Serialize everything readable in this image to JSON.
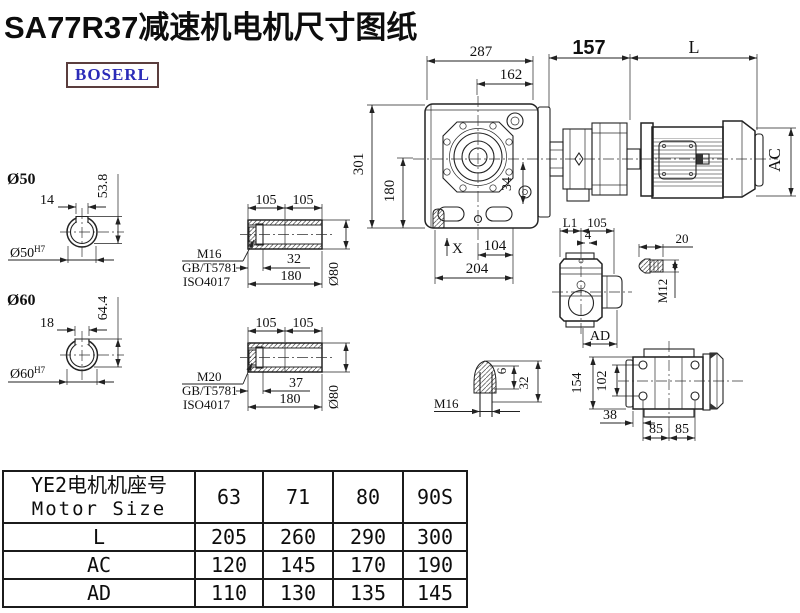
{
  "title": "SA77R37减速机电机尺寸图纸",
  "logo_text": "BOSERL",
  "main_view": {
    "dim_287": "287",
    "dim_162": "162",
    "dim_157": "157",
    "dim_L": "L",
    "dim_AC": "AC",
    "dim_301": "301",
    "dim_180": "180",
    "dim_34": "34",
    "dim_X": "X",
    "dim_104": "104",
    "dim_204": "204"
  },
  "shaft_50": {
    "title": "Ø50",
    "bore_label": "Ø50",
    "bore_tolerance": "H7",
    "key_width": "14",
    "key_depth": "53.8",
    "bolt_callout": {
      "line1": "M16",
      "line2": "GB/T5781",
      "line3": "ISO4017"
    }
  },
  "shaft_60": {
    "title": "Ø60",
    "bore_label": "Ø60",
    "bore_tolerance": "H7",
    "key_width": "18",
    "key_depth": "64.4",
    "bolt_callout": {
      "line1": "M20",
      "line2": "GB/T5781",
      "line3": "ISO4017"
    }
  },
  "hollow_shaft_top": {
    "dim_105_left": "105",
    "dim_105_right": "105",
    "dim_32": "32",
    "dim_180": "180",
    "dim_diameter": "Ø80"
  },
  "hollow_shaft_bottom": {
    "dim_105_left": "105",
    "dim_105_right": "105",
    "dim_37": "37",
    "dim_180": "180",
    "dim_diameter": "Ø80"
  },
  "side_view": {
    "dim_L1": "L1",
    "dim_105": "105",
    "dim_4": "4",
    "dim_AD": "AD"
  },
  "pin_view": {
    "dim_20": "20",
    "dim_M12": "M12"
  },
  "plug_view": {
    "dim_M16": "M16",
    "dim_6": "6",
    "dim_32": "32"
  },
  "rear_view": {
    "dim_154": "154",
    "dim_102": "102",
    "dim_38": "38",
    "dim_85_left": "85",
    "dim_85_right": "85"
  },
  "table": {
    "header": {
      "row_label_cn": "YE2电机机座号",
      "row_label_en": "Motor Size",
      "columns": [
        "63",
        "71",
        "80",
        "90S"
      ]
    },
    "rows": [
      {
        "label": "L",
        "values": [
          "205",
          "260",
          "290",
          "300"
        ]
      },
      {
        "label": "AC",
        "values": [
          "120",
          "145",
          "170",
          "190"
        ]
      },
      {
        "label": "AD",
        "values": [
          "110",
          "130",
          "135",
          "145"
        ]
      }
    ]
  }
}
